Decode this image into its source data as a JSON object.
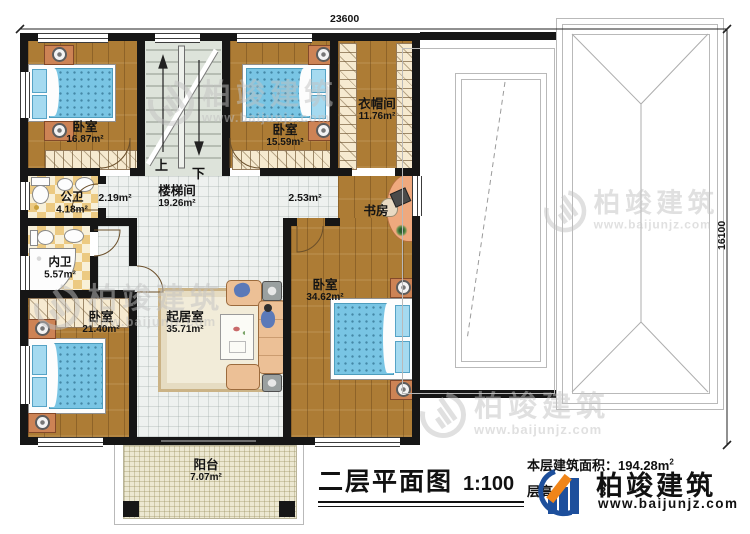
{
  "title": {
    "text": "二层平面图",
    "scale": "1:100"
  },
  "info": {
    "area_label": "本层建筑面积：",
    "area_value": "194.28m",
    "area_sup": "2",
    "floor_height_label": "层高",
    "floor_height_visible": "3"
  },
  "brand": {
    "name": "柏竣建筑",
    "url": "www.baijunjz.com"
  },
  "dimensions": {
    "top": "23600",
    "right": "16100"
  },
  "stairs": {
    "up": "上",
    "down": "下"
  },
  "rooms": {
    "bedroom1": {
      "name": "卧室",
      "area": "16.87m²"
    },
    "bedroom2": {
      "name": "卧室",
      "area": "15.59m²"
    },
    "cloakroom": {
      "name": "衣帽间",
      "area": "11.76m²"
    },
    "stairwell": {
      "name": "楼梯间",
      "area": "19.26m²"
    },
    "hall_left": {
      "area": "2.19m²"
    },
    "hall_right": {
      "area": "2.53m²"
    },
    "public_bath": {
      "name": "公卫",
      "area": "4.18m²"
    },
    "private_bath": {
      "name": "内卫",
      "area": "5.57m²"
    },
    "study": {
      "name": "书房"
    },
    "bedroom3": {
      "name": "卧室",
      "area": "21.40m²"
    },
    "living": {
      "name": "起居室",
      "area": "35.71m²"
    },
    "bedroom4": {
      "name": "卧室",
      "area": "34.62m²"
    },
    "balcony": {
      "name": "阳台",
      "area": "7.07m²"
    }
  },
  "colors": {
    "wall": "#161616",
    "wood": "#ad7c35",
    "bath_tile": "#ecca82",
    "stair_floor": "#dde3da",
    "bed_blue": "#79c5e4",
    "brand_blue": "#1d4f9c",
    "brand_orange": "#f08519",
    "watermark": "#c2c2c2"
  }
}
